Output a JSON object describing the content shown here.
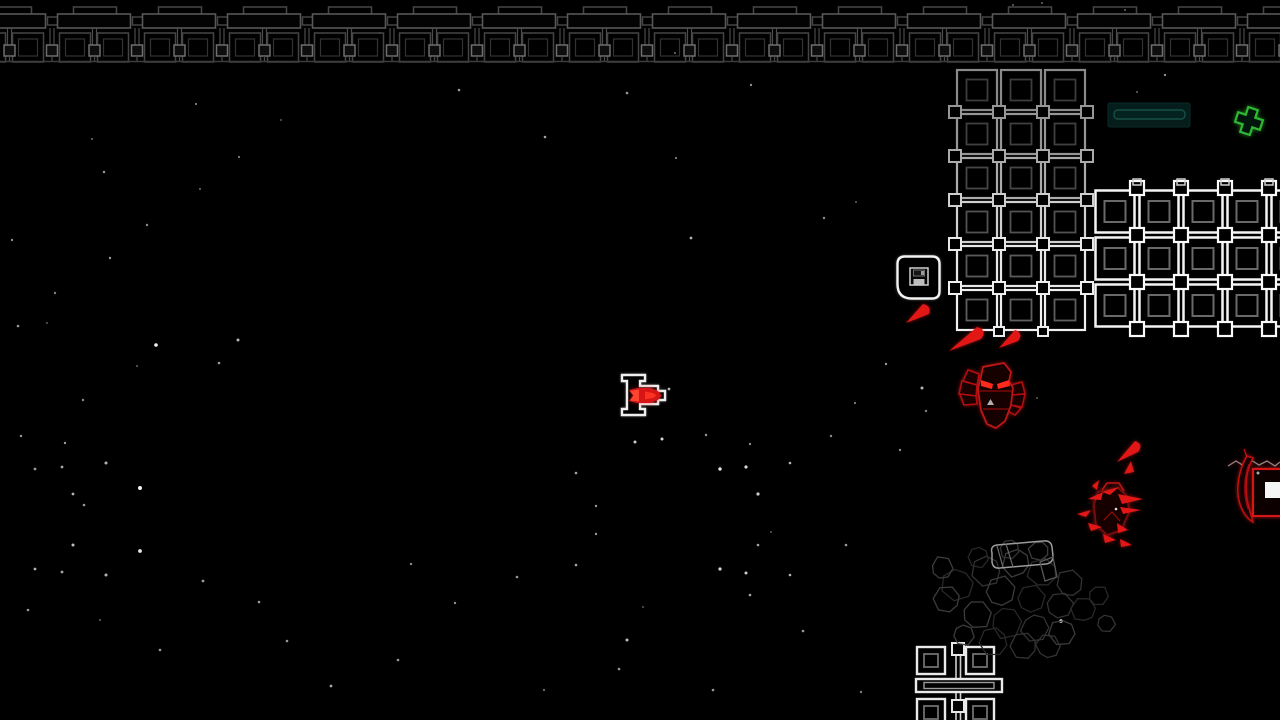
{
  "scene": {
    "width": 1280,
    "height": 720,
    "background": "#000000",
    "label": "top-down space shooter playfield"
  },
  "palette": {
    "star_white": "#ffffff",
    "girder_dim": "#474747",
    "girder_bar": "#585858",
    "girder_tile": "#454545",
    "girder_inner": "#323232",
    "girder_post": "#4b4b4b",
    "girder_node": "#6e6e6e",
    "girder_rail": "#3d3d3d",
    "grid_bright": "#f4f4f4",
    "grid_inner": "#696969",
    "enemy_red": "#c31414",
    "enemy_red_dark": "#8f0d0d",
    "enemy_eye": "#ff2a1e",
    "shard_red": "#e31616",
    "player_outline": "#efefef",
    "player_core": "#d61414",
    "player_core_bright": "#ff4433",
    "pickup_green": "#2eb832",
    "panel_fill": "#051e1b",
    "panel_inner_stroke": "#175046",
    "rubble_gray": "#2e2e2e",
    "save_white": "#f2f2f2"
  },
  "starfield": {
    "stars": [
      [
        196,
        104,
        1.1,
        0.5
      ],
      [
        92,
        139,
        1,
        0.45
      ],
      [
        239,
        157,
        1.1,
        0.5
      ],
      [
        104,
        172,
        1.2,
        0.6
      ],
      [
        200,
        189,
        1,
        0.45
      ],
      [
        147,
        225,
        1.2,
        0.55
      ],
      [
        12,
        240,
        1.2,
        0.55
      ],
      [
        110,
        258,
        1.2,
        0.6
      ],
      [
        55,
        293,
        1.2,
        0.5
      ],
      [
        18,
        326,
        1.3,
        0.6
      ],
      [
        47,
        323,
        1,
        0.35
      ],
      [
        156,
        345,
        1.8,
        0.95
      ],
      [
        238,
        340,
        1.5,
        0.7
      ],
      [
        219,
        363,
        1.3,
        0.6
      ],
      [
        137,
        366,
        1,
        0.4
      ],
      [
        83,
        400,
        1.2,
        0.55
      ],
      [
        21,
        436,
        1.2,
        0.6
      ],
      [
        65,
        443,
        1.2,
        0.6
      ],
      [
        106,
        463,
        1.5,
        0.7
      ],
      [
        62,
        467,
        1.4,
        0.65
      ],
      [
        35,
        469,
        1.4,
        0.6
      ],
      [
        140,
        488,
        2,
        0.95
      ],
      [
        73,
        494,
        1.4,
        0.7
      ],
      [
        84,
        505,
        1.3,
        0.6
      ],
      [
        73,
        545,
        1.5,
        0.75
      ],
      [
        140,
        551,
        1.9,
        0.9
      ],
      [
        35,
        569,
        1.4,
        0.7
      ],
      [
        62,
        572,
        1.4,
        0.65
      ],
      [
        106,
        575,
        1.5,
        0.7
      ],
      [
        203,
        581,
        1.4,
        0.6
      ],
      [
        259,
        602,
        1.3,
        0.6
      ],
      [
        287,
        641,
        1.3,
        0.6
      ],
      [
        331,
        686,
        1.4,
        0.65
      ],
      [
        398,
        660,
        1.3,
        0.6
      ],
      [
        411,
        564,
        1.2,
        0.55
      ],
      [
        455,
        603,
        1.2,
        0.55
      ],
      [
        517,
        577,
        1.3,
        0.6
      ],
      [
        459,
        90,
        1.3,
        0.6
      ],
      [
        627,
        93,
        1.3,
        0.6
      ],
      [
        751,
        85,
        1.2,
        0.55
      ],
      [
        675,
        53,
        1,
        0.45
      ],
      [
        545,
        137,
        1.3,
        0.65
      ],
      [
        676,
        158,
        1.1,
        0.5
      ],
      [
        691,
        238,
        1.4,
        0.7
      ],
      [
        824,
        218,
        1.2,
        0.55
      ],
      [
        856,
        202,
        1,
        0.4
      ],
      [
        635,
        442,
        1.5,
        0.8
      ],
      [
        662,
        439,
        1.5,
        0.85
      ],
      [
        706,
        435,
        1.2,
        0.6
      ],
      [
        750,
        444,
        1.2,
        0.55
      ],
      [
        720,
        469,
        1.7,
        0.9
      ],
      [
        746,
        467,
        1.6,
        0.85
      ],
      [
        790,
        463,
        1.3,
        0.7
      ],
      [
        576,
        473,
        1.3,
        0.65
      ],
      [
        596,
        506,
        1.2,
        0.6
      ],
      [
        758,
        494,
        1.6,
        0.8
      ],
      [
        596,
        534,
        1.2,
        0.6
      ],
      [
        771,
        532,
        1,
        0.35
      ],
      [
        758,
        545,
        1.3,
        0.65
      ],
      [
        576,
        565,
        1.3,
        0.65
      ],
      [
        720,
        569,
        1.6,
        0.85
      ],
      [
        746,
        573,
        1.5,
        0.8
      ],
      [
        790,
        575,
        1.3,
        0.7
      ],
      [
        750,
        595,
        1.3,
        0.65
      ],
      [
        627,
        640,
        1.5,
        0.75
      ],
      [
        643,
        607,
        1,
        0.35
      ],
      [
        619,
        669,
        1.3,
        0.6
      ],
      [
        713,
        690,
        1.3,
        0.6
      ],
      [
        803,
        631,
        1.3,
        0.6
      ],
      [
        861,
        692,
        1.2,
        0.5
      ],
      [
        544,
        690,
        1.1,
        0.45
      ],
      [
        669,
        389,
        1.4,
        0.7
      ],
      [
        886,
        364,
        1.2,
        0.6
      ],
      [
        922,
        388,
        1.5,
        0.7
      ],
      [
        926,
        411,
        1.2,
        0.5
      ],
      [
        900,
        450,
        1.2,
        0.55
      ],
      [
        846,
        545,
        1.3,
        0.6
      ],
      [
        831,
        436,
        1.2,
        0.55
      ],
      [
        855,
        403,
        1.1,
        0.5
      ],
      [
        1165,
        75,
        1.2,
        0.55
      ],
      [
        1137,
        92,
        1,
        0.4
      ],
      [
        1042,
        3,
        1,
        0.4
      ],
      [
        1125,
        10,
        1,
        0.4
      ],
      [
        1037,
        398,
        1,
        0.35
      ],
      [
        1013,
        5,
        1,
        0.4
      ],
      [
        380,
        33,
        1,
        0.35
      ],
      [
        281,
        120,
        1,
        0.35
      ],
      [
        160,
        650,
        1.3,
        0.6
      ],
      [
        28,
        610,
        1.3,
        0.6
      ],
      [
        100,
        620,
        1,
        0.4
      ],
      [
        1061,
        621,
        1.8,
        0.9
      ]
    ]
  },
  "top_girder": {
    "x_start": -30.5,
    "unit_width": 85,
    "units": 16,
    "post_spacing": 42.5,
    "rail_y": 61.5,
    "notch": [
      19,
      7,
      43,
      9
    ],
    "bar": [
      3,
      14,
      73,
      14
    ],
    "coupler": [
      78,
      17,
      12,
      8
    ],
    "tile_a": [
      5,
      33,
      31,
      29
    ],
    "tile_b": [
      43,
      33,
      31,
      29
    ],
    "inner_inset": [
      6,
      6,
      19,
      17
    ]
  },
  "grids": {
    "upper": {
      "x": 955,
      "y": 68,
      "cols": 3,
      "rows": 6,
      "cell": 44,
      "row_strokes": [
        "#8a8a8a",
        "#969696",
        "#ababab",
        "#cfcfcf",
        "#e8e8e8",
        "#efefef"
      ],
      "inner_strokes": [
        "#3c3c3c",
        "#404040",
        "#464646",
        "#525252",
        "#5a5a5a",
        "#5e5e5e"
      ]
    },
    "right": {
      "x": 1093,
      "y": 188,
      "cols": 5,
      "rows": 3,
      "cell_w": 44,
      "cell_h": 47,
      "stroke": "#f4f4f4",
      "inner_stroke": "#696969",
      "node_stroke": "#fafafa"
    }
  },
  "bottom_structure": {
    "node_top": [
      952,
      643,
      12,
      12
    ],
    "node_mid": [
      952,
      700,
      12,
      12
    ],
    "tiles": [
      [
        917,
        647,
        28,
        27
      ],
      [
        966,
        647,
        28,
        27
      ],
      [
        917,
        699,
        28,
        27
      ],
      [
        966,
        699,
        28,
        27
      ]
    ],
    "inners": [
      [
        924,
        654,
        14,
        13
      ],
      [
        973,
        654,
        14,
        13
      ],
      [
        924,
        706,
        14,
        13
      ],
      [
        973,
        706,
        14,
        13
      ]
    ],
    "beam": [
      916,
      679,
      86,
      13
    ],
    "beam_inner": [
      924,
      682.5,
      70,
      6
    ],
    "posts": [
      [
        956,
        647,
        956,
        679
      ],
      [
        960.5,
        647,
        960.5,
        679
      ],
      [
        956,
        692,
        956,
        720
      ],
      [
        960.5,
        692,
        960.5,
        720
      ]
    ]
  },
  "save_station": {
    "icon": "floppy-disk-icon",
    "box_path": "M905,256.5 H932 Q939.5,256.5 939.5,264 V291 Q939.5,298.5 932,298.5 H912 Q897.5,298.5 897.5,284 V264 Q897.5,256.5 905,256.5 Z",
    "floppy_outer": [
      910,
      268,
      18,
      17
    ],
    "floppy_label": [
      913.5,
      270,
      11,
      6
    ],
    "floppy_tick": [
      921,
      271,
      3,
      4
    ],
    "floppy_base": [
      913.5,
      279,
      11,
      5.5
    ]
  },
  "status_panel": {
    "outer": [
      1108,
      103,
      82,
      24
    ],
    "inner": [
      1114,
      110,
      71,
      9
    ]
  },
  "pickup_cross": {
    "cx": 1249,
    "cy": 121,
    "arm": 13,
    "half": 5,
    "rotation": 18
  },
  "player_ship": {
    "outline_path": "M622,375 H645 V381 H640 V386 H658 V391 H665 V400 H658 V404 H640 V409 H645 V415 H622 V409 H627 V381 H622 Z",
    "core_path": "M629,390 L638,388 L651,388 L658,391 L661.5,395.5 L658,400 L651,403 L638,403 L629,401 L633,395.5 Z",
    "core_left_path": "M630,391 L639,389.5 L639,401.5 L630,400.5 L633.5,395.5 Z",
    "core_nose_path": "M645,391.5 L653,393 L656.5,395.5 L653,398 L645,399.5 Z"
  },
  "enemies": {
    "mech": {
      "body": "M983,367 L1004,363 L1011,372 L1009,381 L1013,388 L1011,405 L1005,421 L996,428 L987,424 L981,410 L978,389 L981,377 Z",
      "midlines": [
        [
          980,
          391,
          1012,
          391
        ],
        [
          983,
          409,
          1009,
          409
        ]
      ],
      "eyes": [
        "M981,380 L993,384 L992,389 L981,386 Z",
        "M997,384 L1009,380 L1010,386 L998,389 Z"
      ],
      "marker": "M987,405 L994,405 L990.5,399 Z",
      "wing_left": [
        "M979,374 L968,370 L963,381 L977,385 Z",
        "M977,385 L962,381 L959,394 L976,396 Z",
        "M976,396 L960,394 L964,405 L977,404 Z"
      ],
      "wing_right": [
        "M1011,385 L1022,382 L1025,394 L1012,395 Z",
        "M1012,395 L1025,394 L1022,407 L1011,405 Z",
        "M1011,405 L1021,408 L1015,415 L1008,411 Z"
      ]
    },
    "swarm": {
      "body": "M1098,492 L1118,488 L1127,496 L1129,512 L1121,530 L1107,535 L1096,524 L1094,505 Z",
      "hat": "M1102,490 L1107,483 L1119,483 L1124,491",
      "legs": "M1104,520 L1112,512 L1120,521",
      "shards": [
        "M1088,499 L1103,492 L1101,500 Z",
        "M1102,492 L1119,487 L1110,495 Z",
        "M1118,494 L1143,499 L1122,504 Z",
        "M1120,507 L1141,510 L1123,514 Z",
        "M1077,514 L1091,510 L1086,517 Z",
        "M1088,523 L1102,527 L1091,531 Z",
        "M1117,523 L1128,530 L1118,533 Z",
        "M1120,539 L1132,545 L1121,547 Z",
        "M1103,534 L1116,540 L1105,543 Z",
        "M1092,486 L1099,480 L1097,490 Z"
      ],
      "lone_shard": "M1124,474 L1131,461 L1134,472 Z",
      "dot": [
        1116,
        509,
        1.3
      ]
    },
    "edge": {
      "scribble": "1228,466 1236,461 1244,466 1251,460 1259,465 1267,461 1275,466 1280,462",
      "claw": "M1247,456 C1239,470 1235,489 1240,504 C1243,513 1248,519 1253,522 C1250,512 1246,500 1246,487 C1246,475 1249,465 1253,458 Z",
      "claw_inner": "M1249,464 C1244,477 1243,494 1248,509",
      "spike": [
        1247,
        457,
        1244,
        449
      ],
      "box": [
        1253,
        469,
        30,
        47
      ],
      "core": [
        1265,
        482,
        15,
        16
      ],
      "dot": [
        1258,
        473,
        1.5
      ]
    }
  },
  "debris_shards": [
    "M906,323 L923,304 Q932,306 929,314 Z",
    "M949,351 L977,327 Q988,330 981,339 Z",
    "M999,348 L1015,330 Q1024,333 1018,341 Z",
    "M1117,462 L1135,441 Q1144,444 1138,452 Z"
  ],
  "rubble": {
    "blobs": [
      [
        958,
        583,
        17
      ],
      [
        988,
        570,
        16
      ],
      [
        1018,
        563,
        15
      ],
      [
        1044,
        574,
        16
      ],
      [
        1070,
        585,
        15
      ],
      [
        1000,
        593,
        17
      ],
      [
        1030,
        600,
        16
      ],
      [
        1058,
        606,
        15
      ],
      [
        975,
        614,
        16
      ],
      [
        1005,
        621,
        17
      ],
      [
        1035,
        626,
        15
      ],
      [
        1063,
        631,
        14
      ],
      [
        995,
        641,
        15
      ],
      [
        1025,
        646,
        14
      ],
      [
        948,
        600,
        14
      ],
      [
        1084,
        611,
        13
      ],
      [
        1048,
        648,
        13
      ],
      [
        941,
        569,
        12
      ],
      [
        1097,
        596,
        11
      ],
      [
        1105,
        623,
        10
      ],
      [
        963,
        634,
        12
      ],
      [
        978,
        556,
        12
      ],
      [
        1010,
        548,
        11
      ],
      [
        1040,
        550,
        11
      ]
    ],
    "capsule": "M992,553 Q990,546 997,545 L1043,541 Q1051,540 1052,547 L1053,556 Q1053,563 1046,564 L1000,568 Q993,569 992,562 Z",
    "capsule_folds": [
      "M1006,544 L1013,567",
      "M997,546 L1003,567"
    ],
    "flap": "M1040,562 L1053,557 L1057,577 L1045,581 Z"
  }
}
